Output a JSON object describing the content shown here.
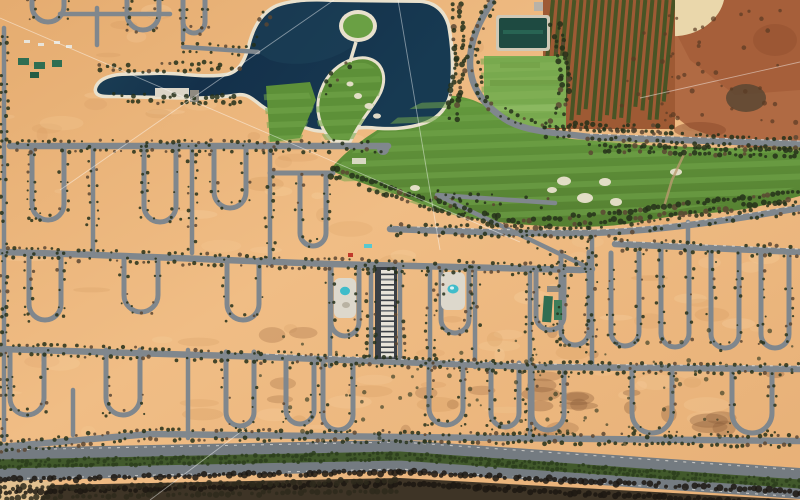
{
  "scene": {
    "description": "aerial-photo-desert-resort-development",
    "features": [
      "lake",
      "golf-course",
      "road-grid-with-cul-de-sac-loops",
      "orchard",
      "construction-site",
      "boulevard",
      "scrubland"
    ]
  },
  "palette": {
    "sand": "#eeb981",
    "sandLight": "#f7d1a0",
    "sandShadow": "#d39a60",
    "sandRed": "#b06a43",
    "sandRedDark": "#8a4a2c",
    "dune": "#ead7ab",
    "road": "#80878d",
    "roadLight": "#9aa1a6",
    "curb": "#e9e6de",
    "water": "#14304a",
    "waterMid": "#1d4459",
    "waterEdge": "#2e5c6d",
    "rim": "#e9e1cd",
    "green": "#5d9038",
    "greenLight": "#72a54b",
    "greenDark": "#3f6a28",
    "island": "#6aa044",
    "field": "#7fae53",
    "pond": "#1e4a41",
    "pondLight": "#2b6a58",
    "orchardSoil": "#9e5a34",
    "orchardRow": "#3d5424",
    "treeDark": "#25301a",
    "treeShadow": "#5a4632",
    "median": "#41592b",
    "scrub": "#3e3426",
    "shadow": "#3a3f45",
    "roofWhite": "#e8e4da",
    "pool": "#3fbcca",
    "campGreen": "#2f6e52",
    "red": "#c0392b",
    "cable": "#ffffff",
    "dirtPath": "#b99a6e",
    "building": "#b8b2a8"
  },
  "cables": [
    [
      0,
      18,
      520,
      242
    ],
    [
      60,
      190,
      334,
      0
    ],
    [
      398,
      0,
      440,
      250
    ],
    [
      150,
      500,
      246,
      428
    ],
    [
      640,
      98,
      800,
      62
    ]
  ],
  "treeDensity": 0.75
}
